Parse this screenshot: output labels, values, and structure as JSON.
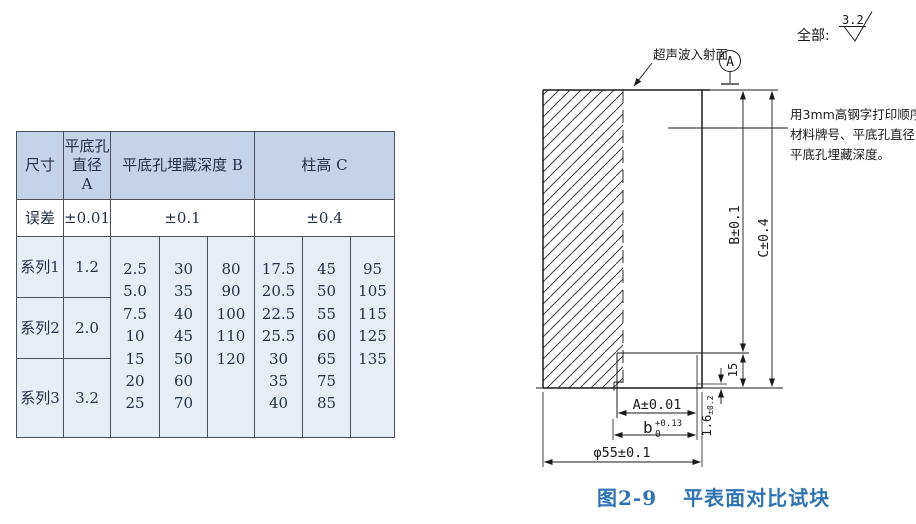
{
  "table": {
    "header": {
      "size": "尺寸",
      "hole_dia": "平底孔\n直径\nA",
      "depth": "平底孔埋藏深度 B",
      "height": "柱高 C"
    },
    "tolerance_row": {
      "label": "误差",
      "a": "±0.01",
      "b": "±0.1",
      "c": "±0.4"
    },
    "series_rows": [
      {
        "label": "系列1",
        "a": "1.2"
      },
      {
        "label": "系列2",
        "a": "2.0"
      },
      {
        "label": "系列3",
        "a": "3.2"
      }
    ],
    "depth_b_cols": [
      [
        "2.5",
        "5.0",
        "7.5",
        "10",
        "15",
        "20",
        "25"
      ],
      [
        "30",
        "35",
        "40",
        "45",
        "50",
        "60",
        "70"
      ],
      [
        "80",
        "90",
        "100",
        "110",
        "120"
      ]
    ],
    "height_c_cols": [
      [
        "17.5",
        "20.5",
        "22.5",
        "25.5",
        "30",
        "35",
        "40"
      ],
      [
        "45",
        "50",
        "55",
        "60",
        "65",
        "75",
        "85"
      ],
      [
        "95",
        "105",
        "115",
        "125",
        "135"
      ]
    ]
  },
  "drawing": {
    "surface_note": "全部:",
    "roughness": "3.2",
    "incident_label": "超声波入射面",
    "datum_label": "A",
    "print_note": [
      "用3mm高钢字打印顺序为:",
      "材料牌号、平底孔直径、",
      "平底孔埋藏深度。"
    ],
    "dims": {
      "b_depth": "B±0.1",
      "c_height": "C±0.4",
      "step15": "15",
      "step16": "1.6",
      "step16_tol": "±0.2",
      "hole_a": "A±0.01",
      "slot_b": "b",
      "slot_b_tol": "+0.13",
      "slot_b_low": "0",
      "dia": "φ55±0.1"
    }
  },
  "caption": {
    "figure_no": "图2-9",
    "title": "平表面对比试块"
  },
  "colors": {
    "table_header_fill": "#c3d4ea",
    "table_body_fill": "#e7edf6",
    "caption_blue": "#2e74b5",
    "line_color": "#1a1a1a"
  }
}
